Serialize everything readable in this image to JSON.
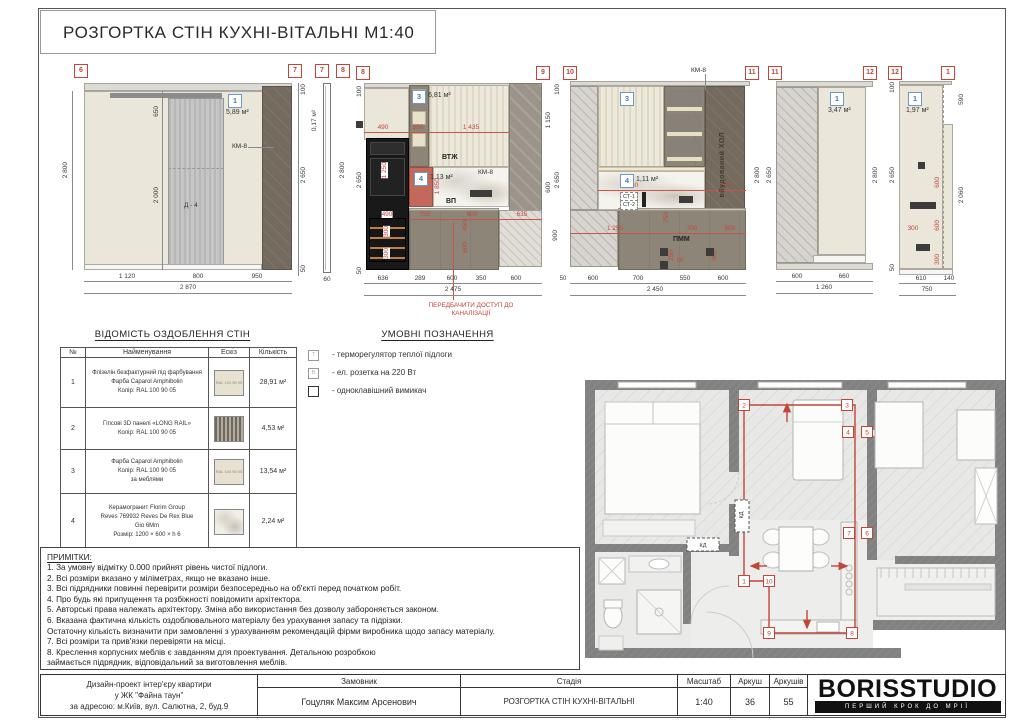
{
  "sheet": {
    "title": "РОЗГОРТКА СТІН КУХНІ-ВІТАЛЬНІ М1:40"
  },
  "elevations": {
    "e67": {
      "marker_l": "6",
      "marker_r": "7",
      "badge": "1",
      "area": "5,89 м²",
      "km8": "КМ-8",
      "door": "Д - 4",
      "l2800": "2 800",
      "d650": "650",
      "d2000": "2 000",
      "r100": "100",
      "r2650": "2 650",
      "r50": "50",
      "b1": "1 120",
      "b2": "800",
      "b3": "950",
      "total": "2 870"
    },
    "e78": {
      "marker_l": "7",
      "marker_r": "8",
      "area": "0,17 м²",
      "r2800": "2 800",
      "b60": "60"
    },
    "e89": {
      "marker_l": "8",
      "marker_r": "9",
      "badge3": "3",
      "area3": "6,81 м²",
      "badge4": "4",
      "area4": "1,13 м²",
      "l100": "100",
      "l2650": "2 650",
      "l50": "50",
      "t490": "490",
      "t550": "550",
      "t1435": "1 435",
      "r1150": "1 150",
      "r600": "600",
      "r900": "900",
      "vtzh": "ВТЖ",
      "vp": "ВП",
      "km8": "КМ-8",
      "d1250": "1 250",
      "d1850": "1 850",
      "d490": "490",
      "d300a": "300",
      "d300b": "300",
      "d750": "750",
      "d600": "600",
      "d635": "635",
      "d450": "450",
      "d600b": "600",
      "b1": "636",
      "b2": "289",
      "b3": "600",
      "b4": "350",
      "b5": "600",
      "total": "2 475",
      "note1": "ПЕРЕДБАЧИТИ ДОСТУП ДО",
      "note2": "КАНАЛІЗАЦІЇ"
    },
    "e1011": {
      "marker_l": "10",
      "marker_r": "11",
      "km8": "КМ-8",
      "badge3": "3",
      "badge4": "4",
      "area4": "1,11 м²",
      "l100": "100",
      "l2650": "2 650",
      "l50": "50",
      "r2800": "2 800",
      "d1550": "1 550",
      "d900": "900",
      "st1": "СТ-1",
      "st2": "СТ-2",
      "hol": "вбудований ХОЛ",
      "d1250": "1 250",
      "d750": "750",
      "d700": "700",
      "d500": "500",
      "pmm": "ПММ",
      "d250": "250",
      "d50": "50",
      "d300": "300",
      "b1": "600",
      "b2": "700",
      "b3": "550",
      "b4": "600",
      "total": "2 450"
    },
    "e1112": {
      "marker_l": "11",
      "marker_r": "12",
      "badge": "1",
      "area": "3,47 м²",
      "l2650": "2 650",
      "r2800": "2 800",
      "b1": "600",
      "b2": "660",
      "total": "1 260"
    },
    "e121": {
      "marker_l": "12",
      "marker_r": "1",
      "badge": "1",
      "area": "1,97 м²",
      "l100": "100",
      "l2650": "2 650",
      "l50": "50",
      "r590": "590",
      "r2060": "2 060",
      "d600a": "600",
      "d600b": "600",
      "d300a": "300",
      "d300b": "300",
      "b1": "610",
      "b2": "140",
      "total": "750"
    }
  },
  "finish_table": {
    "title": "ВІДОМІСТЬ ОЗДОБЛЕННЯ СТІН",
    "headers": [
      "№",
      "Найменування",
      "Ескіз",
      "Кількість"
    ],
    "rows": [
      {
        "num": "1",
        "name": "Флізелін безфактурний під фарбування\nФарба Caparol Amphibolin\nКолір: RAL 100 90 05",
        "sketch": "RAL 100 90 05",
        "qty": "28,91 м²"
      },
      {
        "num": "2",
        "name": "Гіпсові 3D панелі «LONG RAIL»\nКолір: RAL 100 90 05",
        "sketch": "",
        "qty": "4,53 м²"
      },
      {
        "num": "3",
        "name": "Фарба Caparol Amphibolin\nКолір: RAL 100 90 05\nза меблями",
        "sketch": "RAL 100 90 05",
        "qty": "13,54 м²"
      },
      {
        "num": "4",
        "name": "Керамогранит Florim Group\nReves 769932 Reves De Rex Blue\nGio 6Mm\nРозмір: 1200 × 600 × h 6",
        "sketch": "",
        "qty": "2,24 м²"
      }
    ]
  },
  "legend": {
    "title": "УМОВНІ ПОЗНАЧЕННЯ",
    "items": [
      {
        "symbol": "Т",
        "text": "- терморегулятор теплої підлоги"
      },
      {
        "symbol": "В",
        "text": "- ел. розетка на 220 Вт"
      },
      {
        "symbol": "",
        "text": "- одноклавішний вимикач"
      }
    ]
  },
  "plan": {
    "markers": [
      "2",
      "3",
      "4",
      "5",
      "7",
      "6",
      "1",
      "10",
      "9",
      "8"
    ],
    "kd": "КД"
  },
  "notes": {
    "title": "ПРИМІТКИ:",
    "lines": [
      "1. За умовну відмітку 0.000 прийнят рівень чистої підлоги.",
      "2. Всі розміри вказано у міліметрах, якщо не вказано інше.",
      "3. Всі підрядники повинні перевірити розміри безпосередньо на об'єкті перед початком робіт.",
      "4. Про будь які припущення та розбіжності повідомити архітектора.",
      "5. Авторські права належать архітектору. Зміна або використання без дозволу забороняється законом.",
      "6. Вказана фактична кількість оздоблювального матеріалу без урахування запасу та підрізки.",
      "Остаточну кількість визначити при замовленні з урахуванням рекомендацій фірми виробника щодо запасу матеріалу.",
      "7. Всі розміри та прив'язки перевіряти на місці.",
      "8. Креслення корпусних меблів є завданням для проектування. Детальною розробкою",
      "займається підрядник, відповідальний за виготовлення меблів."
    ]
  },
  "titleblock": {
    "project_line1": "Дизайн-проект інтер'єру квартири",
    "project_line2": "у ЖК \"Файна таун\"",
    "project_line3": "за адресою: м.Київ, вул. Салютна, 2, буд.9",
    "customer_label": "Замовник",
    "customer": "Гоцуляк Максим Арсенович",
    "stage_label": "Стадія",
    "stage": "РОЗГОРТКА СТІН КУХНІ-ВІТАЛЬНІ",
    "scale_label": "Масштаб",
    "scale": "1:40",
    "sheet_label": "Аркуш",
    "sheet": "36",
    "sheets_label": "Аркушів",
    "sheets": "55",
    "logo": "BORISSTUDIO",
    "tagline": "ПЕРШИЙ КРОК ДО МРІЇ"
  }
}
